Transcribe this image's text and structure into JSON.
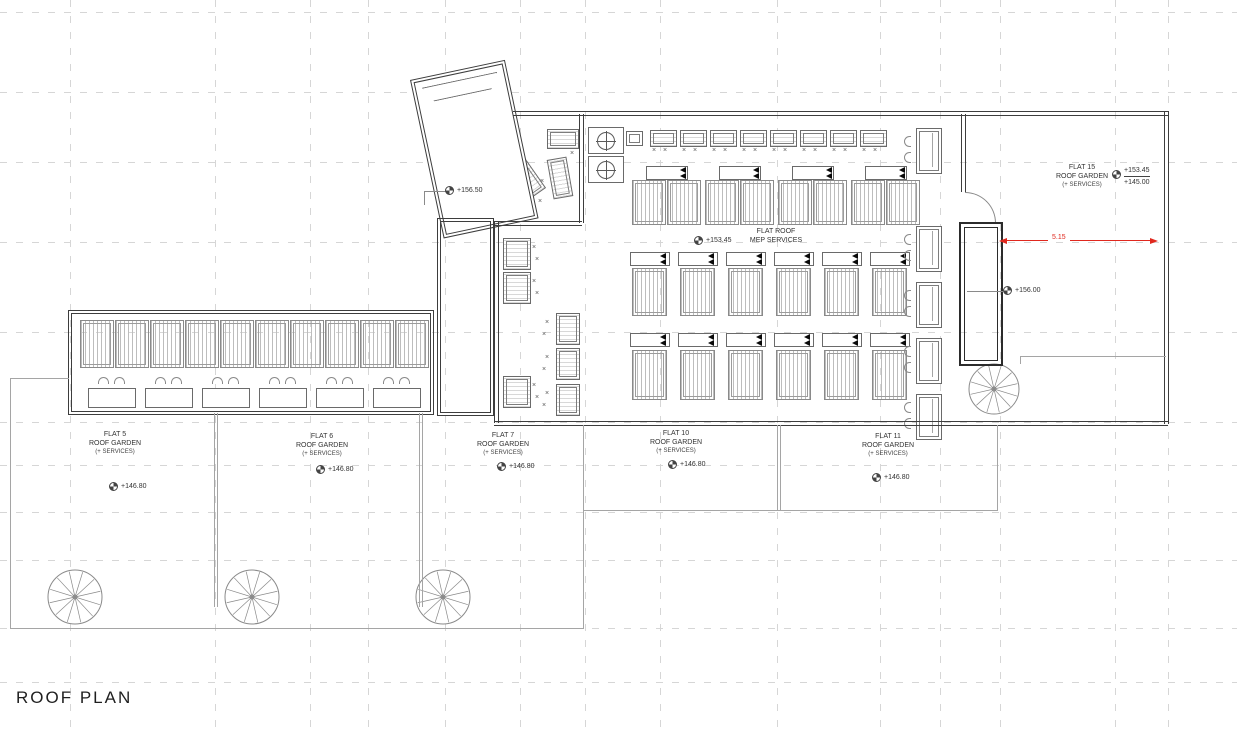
{
  "drawing": {
    "title": "ROOF PLAN",
    "dimension_value": "5.15",
    "colors": {
      "dimension": "#e0281e",
      "walls": "#3d3d3d"
    },
    "levels": {
      "tower": "+156.50",
      "core": "+156.00"
    },
    "flat_roof": {
      "name": "FLAT ROOF",
      "sub": "MEP SERVICES",
      "level": "+153.45"
    },
    "flats": [
      {
        "name": "FLAT 5",
        "type": "ROOF GARDEN",
        "services": "(+ SERVICES)",
        "level": "+146.80"
      },
      {
        "name": "FLAT 6",
        "type": "ROOF GARDEN",
        "services": "(+ SERVICES)",
        "level": "+146.80"
      },
      {
        "name": "FLAT 7",
        "type": "ROOF GARDEN",
        "services": "(+ SERVICES)",
        "level": "+146.80"
      },
      {
        "name": "FLAT 10",
        "type": "ROOF GARDEN",
        "services": "(+ SERVICES)",
        "level": "+146.80"
      },
      {
        "name": "FLAT 11",
        "type": "ROOF GARDEN",
        "services": "(+ SERVICES)",
        "level": "+146.80"
      },
      {
        "name": "FLAT 15",
        "type": "ROOF GARDEN",
        "services": "(+ SERVICES)",
        "level_upper": "+153.45",
        "level_lower": "+145.00"
      }
    ]
  }
}
